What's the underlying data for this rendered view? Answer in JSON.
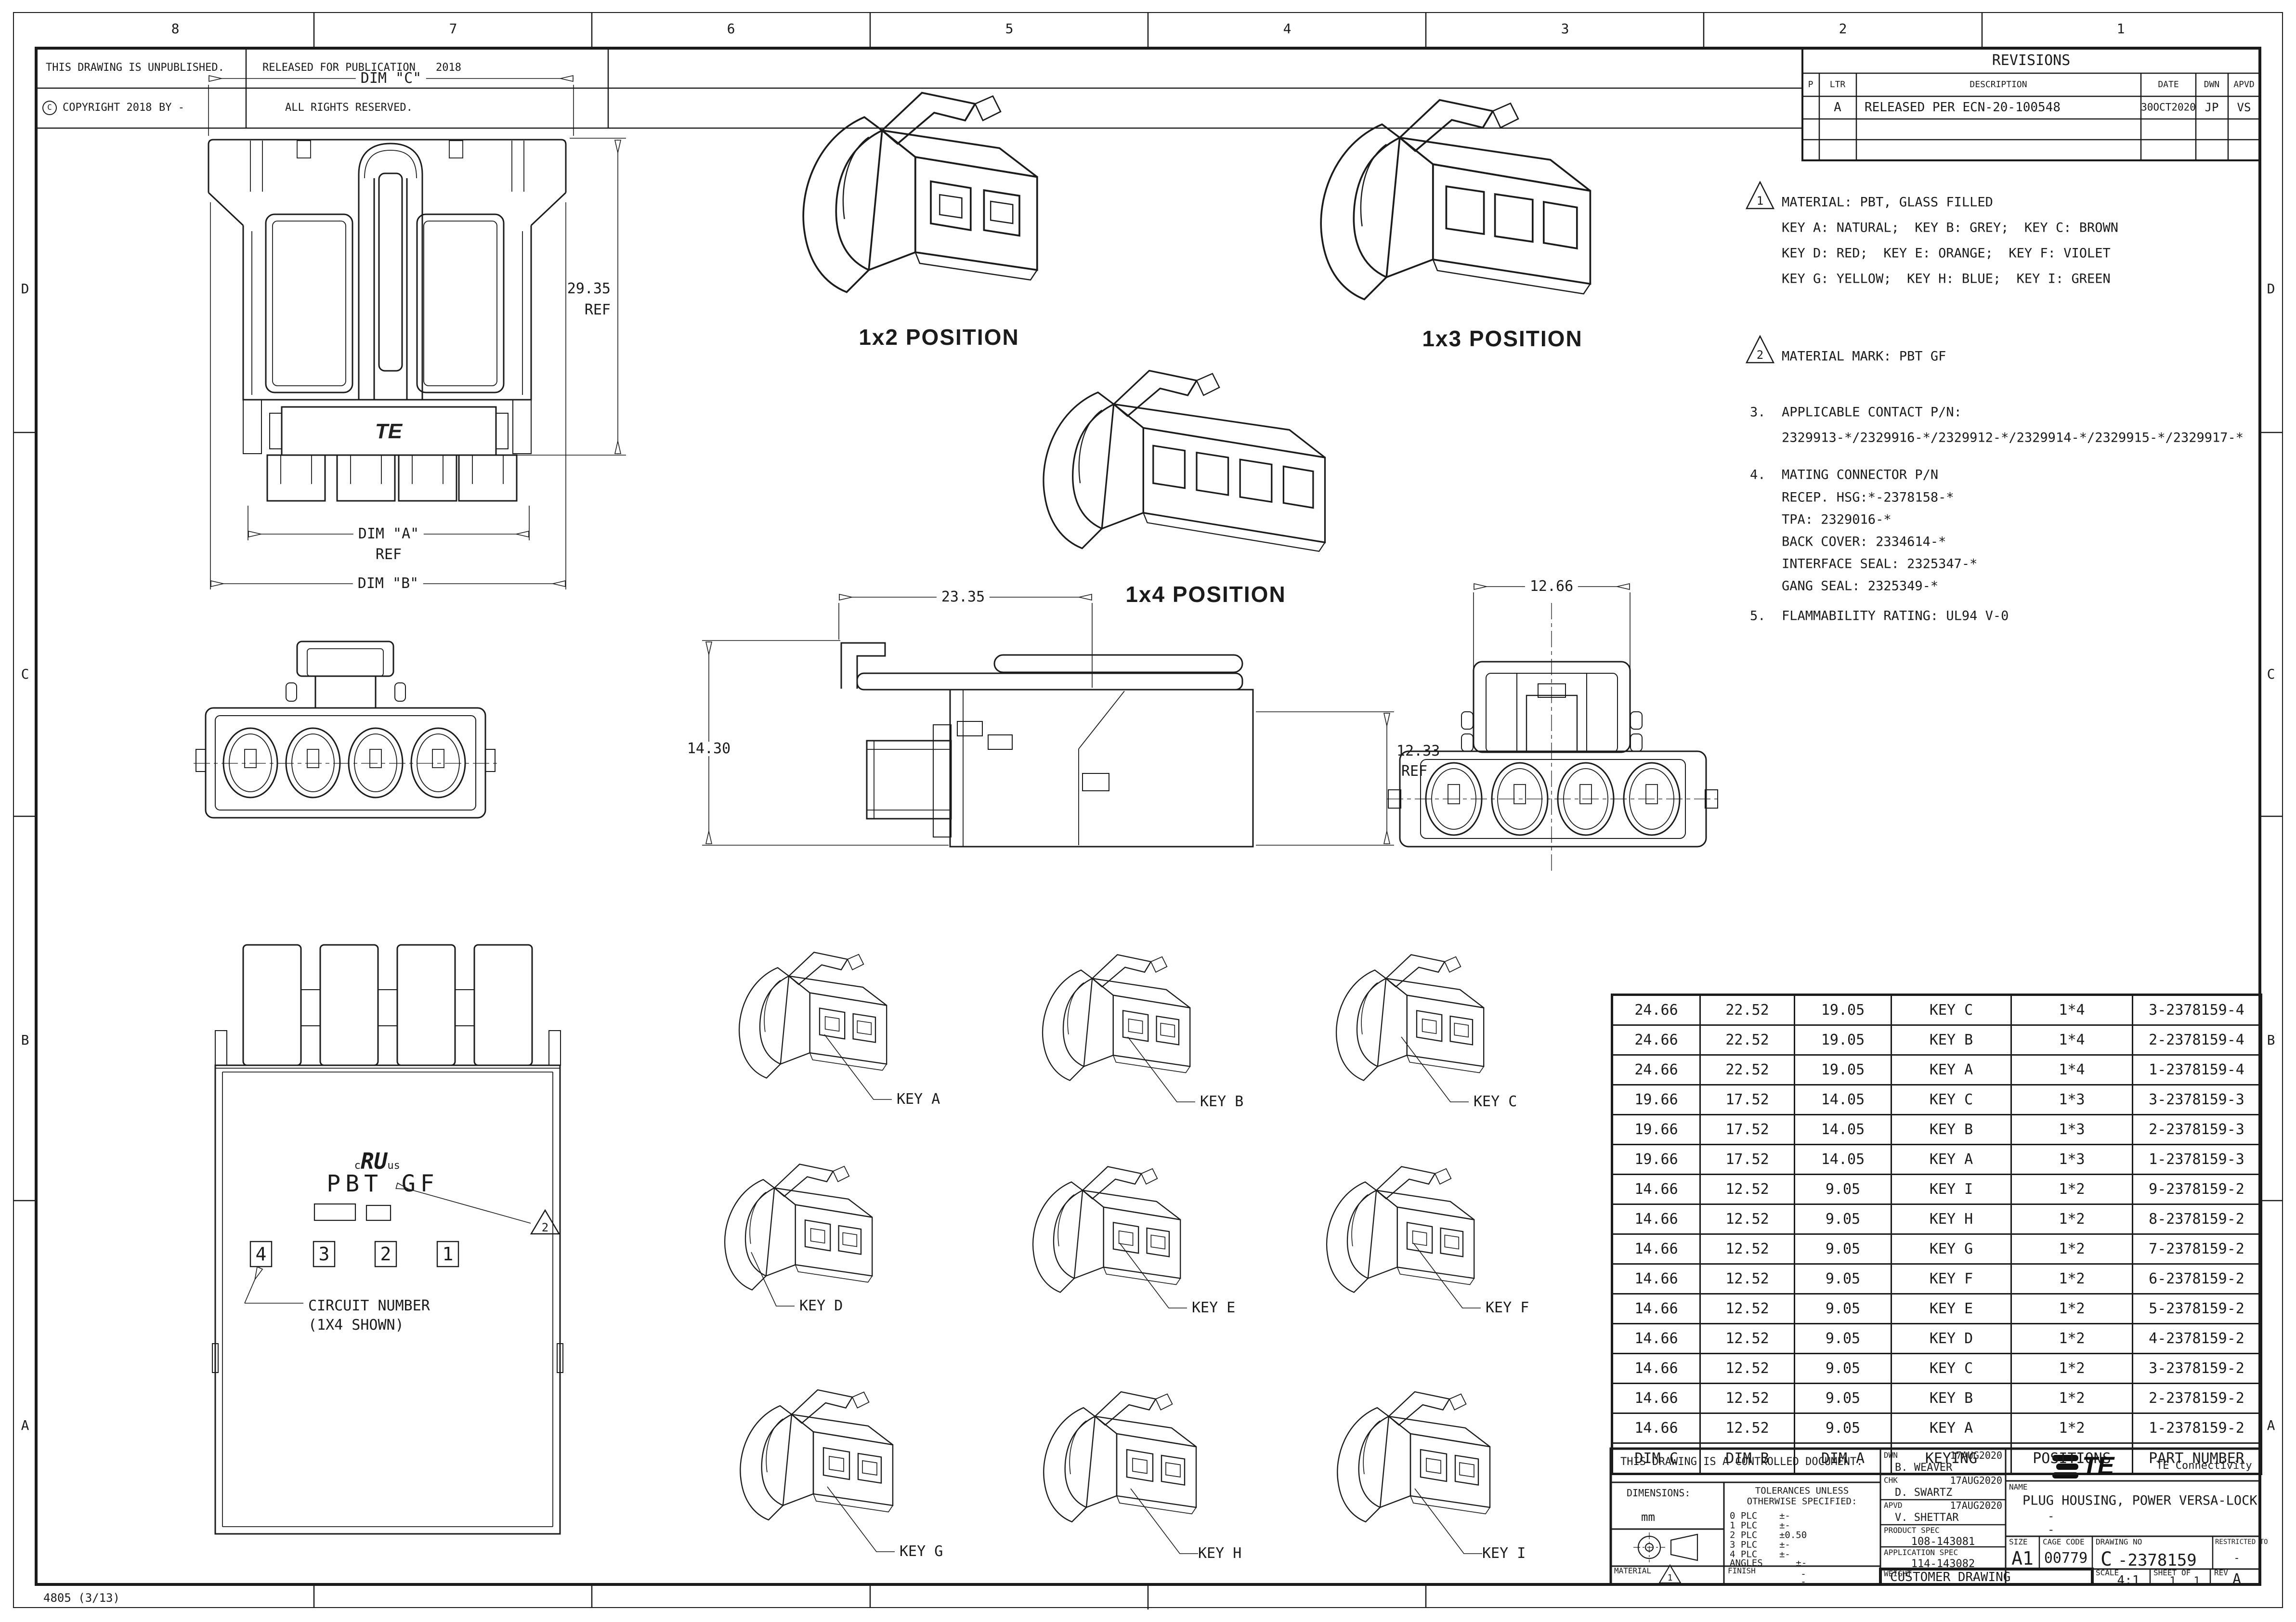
{
  "sheet": {
    "zones_top": [
      "8",
      "7",
      "6",
      "5",
      "4",
      "3",
      "2",
      "1"
    ],
    "zones_side": [
      "D",
      "C",
      "B",
      "A"
    ],
    "form_code": "4805 (3/13)"
  },
  "header_strip": {
    "unpublished": "THIS DRAWING IS UNPUBLISHED.",
    "released_for_publication": "RELEASED FOR PUBLICATION",
    "released_year": "2018",
    "copyright_symbol": "C",
    "copyright_text": "COPYRIGHT 2018",
    "copyright_by": "BY -",
    "all_rights": "ALL RIGHTS RESERVED."
  },
  "revisions": {
    "title": "REVISIONS",
    "col_p": "P",
    "col_ltr": "LTR",
    "col_description": "DESCRIPTION",
    "col_date": "DATE",
    "col_dwn": "DWN",
    "col_apvd": "APVD",
    "row": {
      "ltr": "A",
      "description": "RELEASED PER ECN-20-100548",
      "date": "30OCT2020",
      "dwn": "JP",
      "apvd": "VS"
    }
  },
  "notes": {
    "flag1": "1",
    "n1_line1": "MATERIAL: PBT, GLASS FILLED",
    "n1_line2": "KEY A: NATURAL;  KEY B: GREY;  KEY C: BROWN",
    "n1_line3": "KEY D: RED;  KEY E: ORANGE;  KEY F: VIOLET",
    "n1_line4": "KEY G: YELLOW;  KEY H: BLUE;  KEY I: GREEN",
    "flag2": "2",
    "n2": "MATERIAL MARK: PBT GF",
    "n3_num": "3.",
    "n3_line1": "APPLICABLE CONTACT P/N:",
    "n3_line2": "2329913-*/2329916-*/2329912-*/2329914-*/2329915-*/2329917-*",
    "n4_num": "4.",
    "n4_line1": "MATING CONNECTOR P/N",
    "n4_line2": "RECEP. HSG:*-2378158-*",
    "n4_line3": "TPA: 2329016-*",
    "n4_line4": "BACK COVER: 2334614-*",
    "n4_line5": "INTERFACE SEAL: 2325347-*",
    "n4_line6": "GANG SEAL: 2325349-*",
    "n5_num": "5.",
    "n5_line1": "FLAMMABILITY RATING: UL94 V-0"
  },
  "views": {
    "pos_1x2": "1x2 POSITION",
    "pos_1x3": "1x3 POSITION",
    "pos_1x4": "1x4 POSITION",
    "front": {
      "dim_c": "DIM \"C\"",
      "h": "29.35",
      "h_ref": "REF",
      "dim_a": "DIM \"A\"",
      "dim_a_ref": "REF",
      "dim_b": "DIM \"B\"",
      "logo": "TE"
    },
    "side": {
      "w": "23.35",
      "h": "14.30",
      "h2": "12.33",
      "h2_ref": "REF"
    },
    "mate": {
      "w": "12.66"
    },
    "back": {
      "ul_c": "c",
      "ul_ru": "RU",
      "ul_us": "us",
      "mark": "PBT GF",
      "digits": [
        "4",
        "3",
        "2",
        "1"
      ],
      "flag": "2",
      "callout1": "CIRCUIT NUMBER",
      "callout2": "(1X4 SHOWN)"
    }
  },
  "keys": [
    "KEY A",
    "KEY B",
    "KEY C",
    "KEY D",
    "KEY E",
    "KEY F",
    "KEY G",
    "KEY H",
    "KEY I"
  ],
  "spec_table": {
    "headers": [
      "DIM C",
      "DIM B",
      "DIM A",
      "KEYING",
      "POSITIONS",
      "PART NUMBER"
    ],
    "rows": [
      [
        "24.66",
        "22.52",
        "19.05",
        "KEY C",
        "1*4",
        "3-2378159-4"
      ],
      [
        "24.66",
        "22.52",
        "19.05",
        "KEY B",
        "1*4",
        "2-2378159-4"
      ],
      [
        "24.66",
        "22.52",
        "19.05",
        "KEY A",
        "1*4",
        "1-2378159-4"
      ],
      [
        "19.66",
        "17.52",
        "14.05",
        "KEY C",
        "1*3",
        "3-2378159-3"
      ],
      [
        "19.66",
        "17.52",
        "14.05",
        "KEY B",
        "1*3",
        "2-2378159-3"
      ],
      [
        "19.66",
        "17.52",
        "14.05",
        "KEY A",
        "1*3",
        "1-2378159-3"
      ],
      [
        "14.66",
        "12.52",
        "9.05",
        "KEY I",
        "1*2",
        "9-2378159-2"
      ],
      [
        "14.66",
        "12.52",
        "9.05",
        "KEY H",
        "1*2",
        "8-2378159-2"
      ],
      [
        "14.66",
        "12.52",
        "9.05",
        "KEY G",
        "1*2",
        "7-2378159-2"
      ],
      [
        "14.66",
        "12.52",
        "9.05",
        "KEY F",
        "1*2",
        "6-2378159-2"
      ],
      [
        "14.66",
        "12.52",
        "9.05",
        "KEY E",
        "1*2",
        "5-2378159-2"
      ],
      [
        "14.66",
        "12.52",
        "9.05",
        "KEY D",
        "1*2",
        "4-2378159-2"
      ],
      [
        "14.66",
        "12.52",
        "9.05",
        "KEY C",
        "1*2",
        "3-2378159-2"
      ],
      [
        "14.66",
        "12.52",
        "9.05",
        "KEY B",
        "1*2",
        "2-2378159-2"
      ],
      [
        "14.66",
        "12.52",
        "9.05",
        "KEY A",
        "1*2",
        "1-2378159-2"
      ]
    ]
  },
  "title_block": {
    "controlled": "THIS DRAWING IS A CONTROLLED DOCUMENT.",
    "dimensions_label": "DIMENSIONS:",
    "units": "mm",
    "tol_line1": "TOLERANCES UNLESS",
    "tol_line2": "OTHERWISE SPECIFIED:",
    "tol_rows": [
      "0 PLC    ±-",
      "1 PLC    ±-",
      "2 PLC    ±0.50",
      "3 PLC    ±-",
      "4 PLC    ±-",
      "ANGLES      ±-"
    ],
    "material_label": "MATERIAL",
    "material_flag": "1",
    "finish_label": "FINISH",
    "finish_v1": "-",
    "finish_v2": "-",
    "dwn_label": "DWN",
    "dwn_name": "B. WEAVER",
    "dwn_date": "17AUG2020",
    "chk_label": "CHK",
    "chk_name": "D. SWARTZ",
    "chk_date": "17AUG2020",
    "apvd_label": "APVD",
    "apvd_name": "V. SHETTAR",
    "apvd_date": "17AUG2020",
    "product_spec_label": "PRODUCT SPEC",
    "product_spec": "108-143081",
    "application_spec_label": "APPLICATION SPEC",
    "application_spec": "114-143082",
    "weight_label": "WEIGHT",
    "weight": "-",
    "logo_text": "TE",
    "company": "TE Connectivity",
    "name_label": "NAME",
    "name": "PLUG HOUSING, POWER VERSA-LOCK",
    "name_sub1": "-",
    "name_sub2": "-",
    "size_label": "SIZE",
    "size": "A1",
    "cage_label": "CAGE CODE",
    "cage": "00779",
    "dwg_label": "DRAWING NO",
    "dwg_prefix": "C",
    "dwg_no": "-2378159",
    "restricted_label": "RESTRICTED TO",
    "restricted": "-",
    "type": "CUSTOMER DRAWING",
    "scale_label": "SCALE",
    "scale": "4:1",
    "sheet_label": "SHEET",
    "sheet_no": "1",
    "of_label": "OF",
    "sheet_total": "1",
    "rev_label": "REV",
    "rev": "A"
  }
}
